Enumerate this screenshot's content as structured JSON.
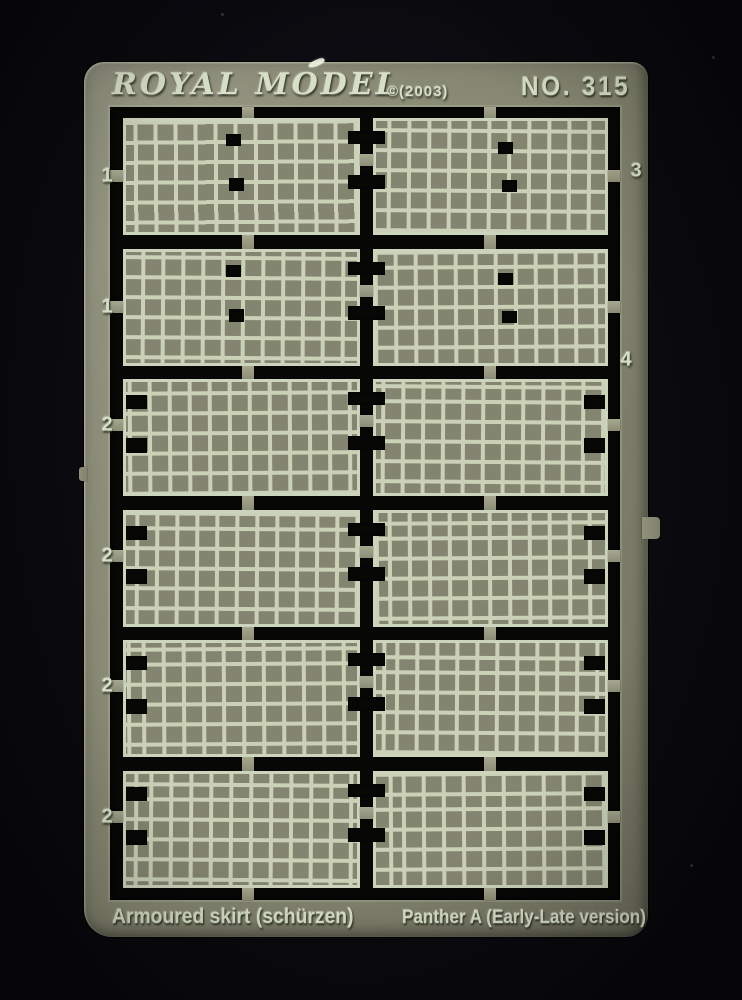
{
  "scene": {
    "description": "Photo of a photo-etched metal fret (model kit part sheet) on a black background",
    "background_color": "#0a0a0e",
    "sheet_color": "#8b8c76",
    "mesh_line_color": "#ced6bb",
    "cutout_color": "#070706",
    "label_color": "#d7dfc6"
  },
  "sheet": {
    "brand": "ROYAL MODEL",
    "copyright": "©(2003)",
    "part_number": "NO. 315",
    "footer_left": "Armoured skirt (schürzen)",
    "footer_right": "Panther A (Early-Late version)"
  },
  "fret": {
    "rows": [
      {
        "left_label": "1",
        "type": "holes"
      },
      {
        "left_label": "1",
        "type": "holes"
      },
      {
        "left_label": "2",
        "type": "notches"
      },
      {
        "left_label": "2",
        "type": "notches"
      },
      {
        "left_label": "2",
        "type": "notches"
      },
      {
        "left_label": "2",
        "type": "notches"
      }
    ],
    "right_labels": [
      "3",
      "4"
    ]
  }
}
